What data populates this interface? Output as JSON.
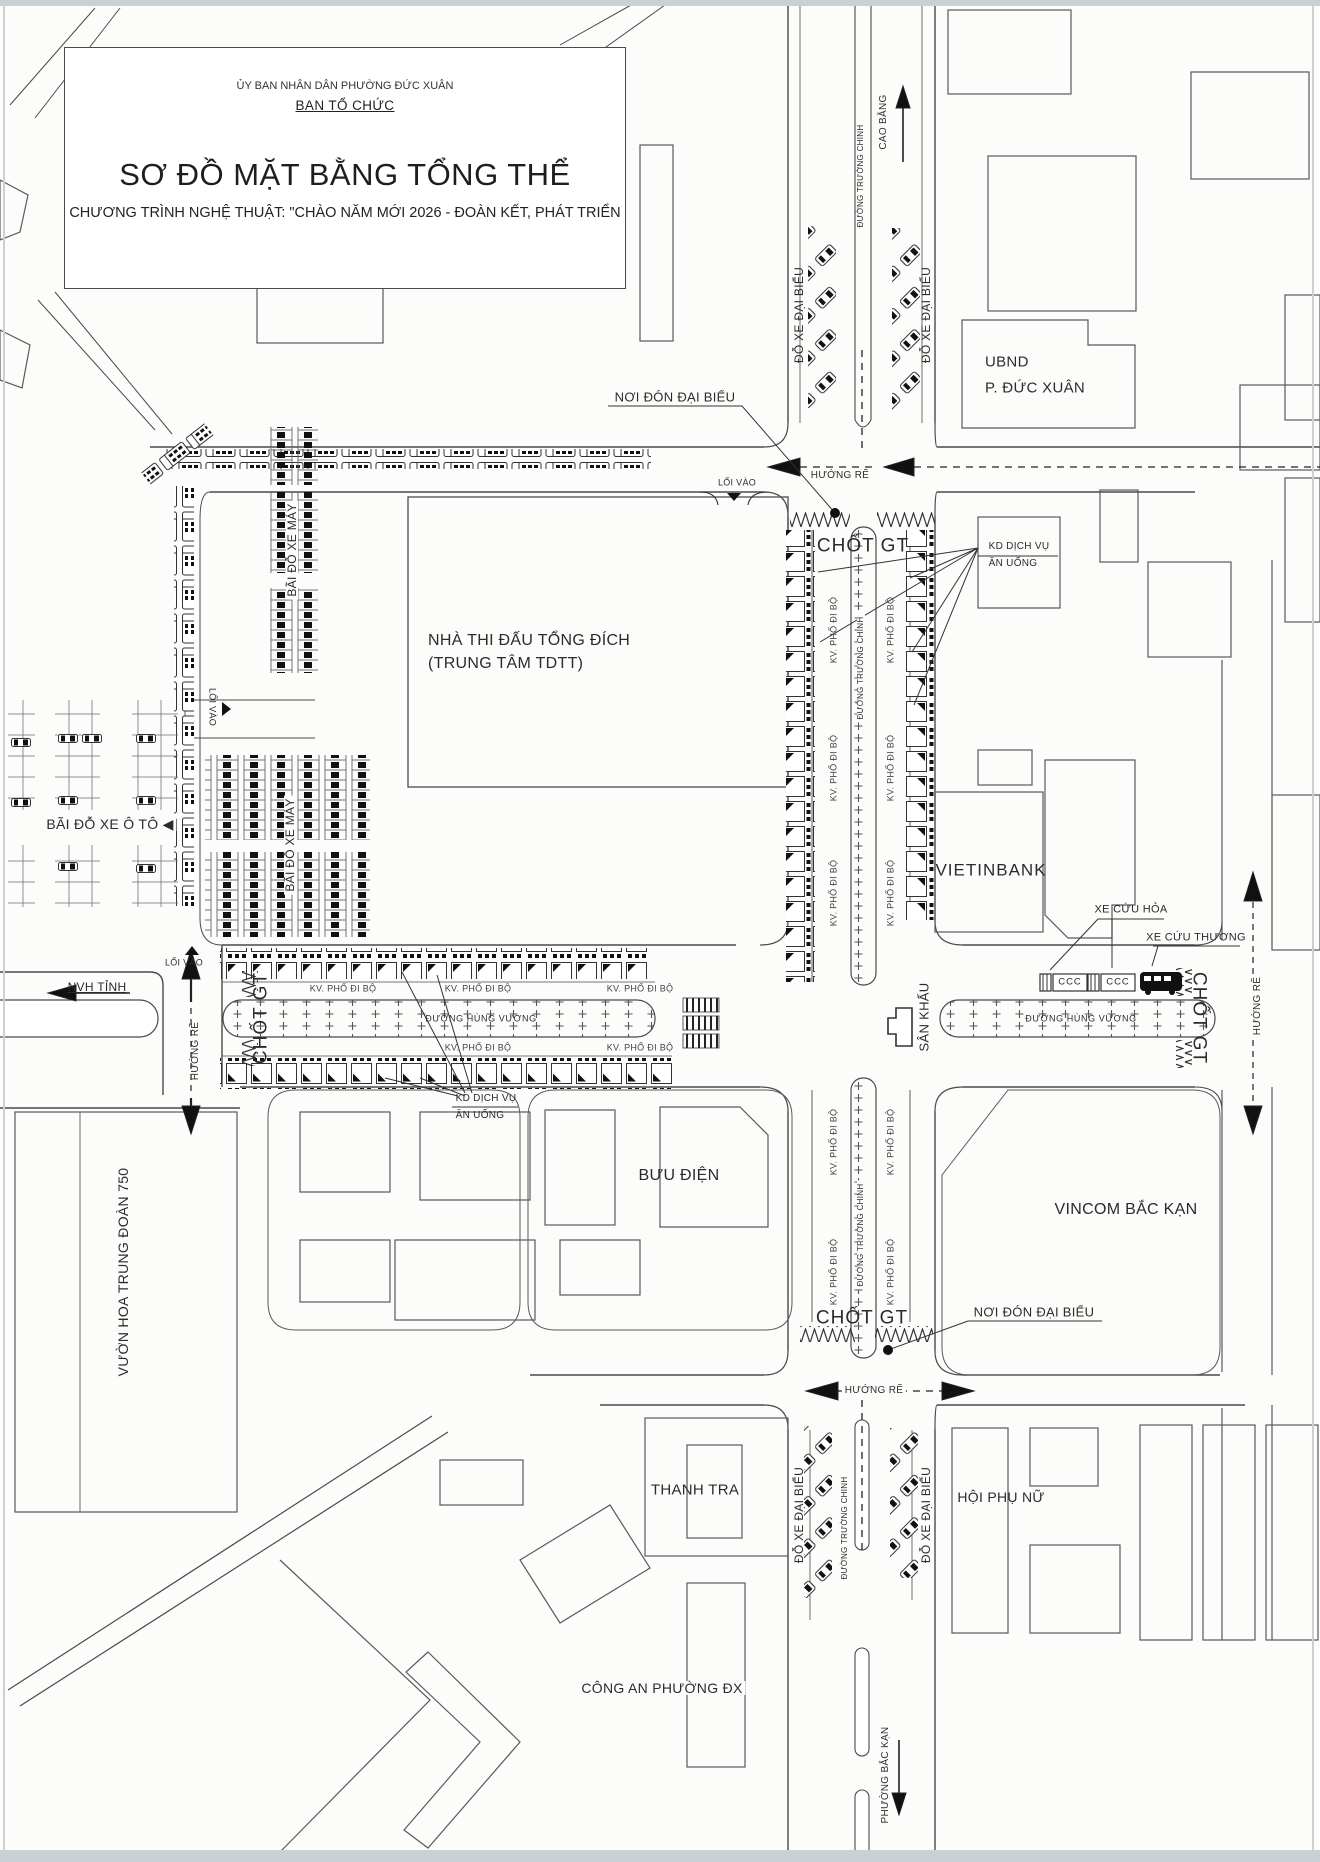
{
  "title_block": {
    "org": "ỦY BAN NHÂN DÂN PHƯỜNG ĐỨC XUÂN",
    "committee": "BAN TỔ CHỨC",
    "title": "SƠ ĐỒ MẶT BẰNG TỔNG THỂ",
    "subtitle": "CHƯƠNG TRÌNH NGHỆ THUẬT: \"CHÀO NĂM MỚI 2026 - ĐOÀN KẾT, PHÁT TRIỂN"
  },
  "labels": {
    "cao_bang": "CAO BẰNG",
    "duong_truong_chinh": "ĐƯỜNG TRƯỜNG CHINH",
    "duong_hung_vuong": "ĐƯỜNG HÙNG VƯƠNG",
    "do_xe_dai_bieu": "ĐỖ XE ĐẠI BIỂU",
    "ubnd_1": "UBND",
    "ubnd_2": "P. ĐỨC XUÂN",
    "noi_don_dai_bieu": "NƠI ĐÓN ĐẠI BIỂU",
    "huong_re": "HƯỚNG RẼ",
    "loi_vao": "LỐI VÀO",
    "chot_gt": "CHỐT GT",
    "kd_dich_vu": "KD DỊCH VỤ",
    "an_uong": "ĂN UỐNG",
    "nha_thi_dau_1": "NHÀ THI ĐẤU TỔNG ĐÍCH",
    "nha_thi_dau_2": "(TRUNG TÂM TDTT)",
    "bai_do_xe_may": "BÃI ĐỖ XE MÁY",
    "bai_do_xe_o_to": "BÃI ĐỖ XE Ô TÔ ◀",
    "kv_pho_di_bo": "KV. PHỐ ĐI BỘ",
    "vietinbank": "VIETINBANK",
    "xe_cuu_hoa": "XE CỨU HỎA",
    "xe_cuu_thuong": "XE CỨU THƯƠNG",
    "ccc": "CCC",
    "san_khau": "SÂN KHẤU",
    "nvh_tinh": "NVH TỈNH",
    "vuon_hoa": "VƯỜN HOA TRUNG ĐOÀN 750",
    "buu_dien": "BƯU ĐIỆN",
    "vincom": "VINCOM BẮC KẠN",
    "thanh_tra": "THANH TRA",
    "cong_an": "CÔNG AN PHƯỜNG ĐX",
    "hoi_phu_nu": "HỘI PHỤ NỮ",
    "phuong_bac_kan": "PHƯỜNG BẮC KẠN"
  },
  "icons": {
    "entry_marker": "triangle",
    "stall_icon": "square-with-black-triangle",
    "car_icon": "plan-view-car",
    "bus_icon": "plan-view-bus",
    "fire_truck_icon": "CCC-truck",
    "ambulance_icon": "black-van",
    "stage_icon": "t-shape",
    "checkpoint_barrier": "zigzag"
  },
  "colors": {
    "ink": "#4a4a4a",
    "text": "#2b2b2b",
    "paper": "#fcfcfb",
    "scan_edge": "#cbd0d4"
  }
}
